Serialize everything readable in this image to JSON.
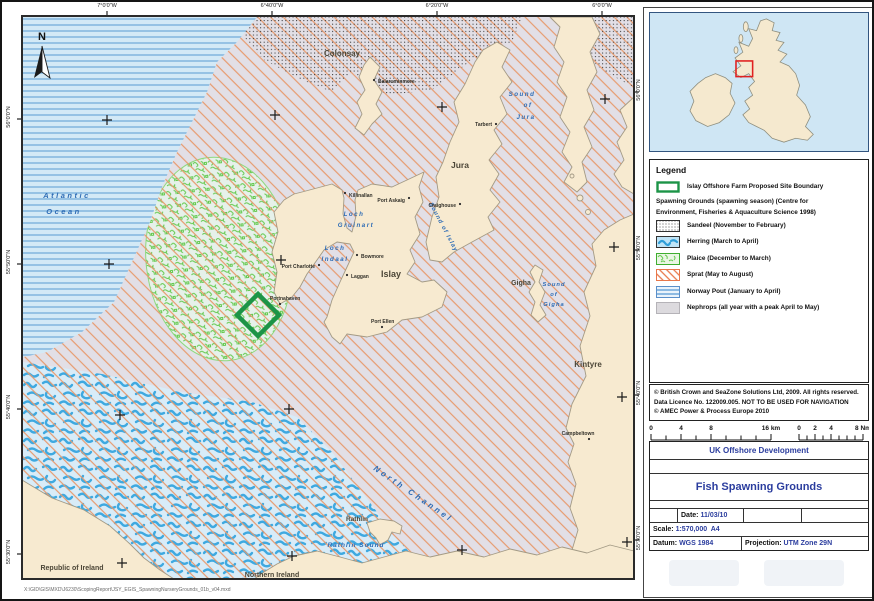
{
  "map": {
    "north_label": "N",
    "axis": {
      "top": [
        "7°0'0\"W",
        "6°40'0\"W",
        "6°20'0\"W",
        "6°0'0\"W"
      ],
      "left": [
        "56°0'0\"N",
        "55°50'0\"N",
        "55°40'0\"N",
        "55°30'0\"N"
      ],
      "right": [
        "56°0'0\"N",
        "55°50'0\"N",
        "55°40'0\"N",
        "55°30'0\"N"
      ]
    },
    "water": {
      "atlantic": [
        "Atlantic",
        "Ocean"
      ],
      "loch_gruinart": [
        "Loch",
        "Gruinart"
      ],
      "loch_indaal": [
        "Loch",
        "Indaal"
      ],
      "sound_of_islay": "Sound of Islay",
      "sound_of_jura": [
        "Sound",
        "of",
        "Jura"
      ],
      "sound_of_gigha": [
        "Sound",
        "of",
        "Gigha"
      ],
      "north_channel": "North Channel",
      "rathlin_sound": "Rathlin Sound"
    },
    "places": {
      "colonsay": "Colonsay",
      "balaruminmore": "Balaruminmore",
      "jura": "Jura",
      "tarbert": "Tarbert",
      "craighouse": "Craighouse",
      "killinallan": "Killinallan",
      "port_askaig": "Port Askaig",
      "islay": "Islay",
      "bowmore": "Bowmore",
      "port_charlotte": "Port Charlotte",
      "laggan": "Laggan",
      "portnahaven": "Portnahaven",
      "port_ellen": "Port Ellen",
      "gigha": "Gigha",
      "kintyre": "Kintyre",
      "campbeltown": "Campbeltown",
      "rathlin": "Rathlin",
      "republic_of_ireland": "Republic of Ireland",
      "northern_ireland": "Northern Ireland"
    },
    "file_path": "X:\\GID\\GIS\\MXD\\J6230\\ScopingReport\\JSY_EGIS_SpawningNurseryGrounds_01b_v04.mxd"
  },
  "legend": {
    "title": "Legend",
    "boundary_label": "Islay Offshore Farm Proposed Site Boundary",
    "subtitle_line1": "Spawning Grounds (spawning season) (Centre for",
    "subtitle_line2": "Environment, Fisheries & Aquaculture Science 1998)",
    "items": [
      {
        "label": "Sandeel (November to February)"
      },
      {
        "label": "Herring (March to April)"
      },
      {
        "label": "Plaice (December to March)"
      },
      {
        "label": "Sprat (May to August)"
      },
      {
        "label": "Norway Pout (January to April)"
      },
      {
        "label": "Nephrops (all year with a peak April to May)"
      }
    ]
  },
  "copyright": {
    "line1": "© British Crown and SeaZone Solutions Ltd, 2009. All rights reserved.",
    "line2": "Data Licence No. 122009.005. NOT TO BE USED FOR NAVIGATION",
    "line3": "© AMEC Power & Process Europe 2010"
  },
  "scalebar": {
    "km_labels": [
      "0",
      "4",
      "8",
      "16 km"
    ],
    "nm_labels": [
      "0",
      "2",
      "4",
      "8 Nm"
    ]
  },
  "titleblock": {
    "project": "UK Offshore Development",
    "title": "Fish Spawning Grounds",
    "date_label": "Date:",
    "date_value": "11/03/10",
    "scale_label": "Scale:",
    "scale_value": "1:570,000  A4",
    "datum_label": "Datum:",
    "datum_value": "WGS 1984",
    "projection_label": "Projection:",
    "projection_value": "UTM Zone 29N"
  },
  "colors": {
    "sea": "#d8ecf8",
    "land": "#f7ead0",
    "sprat_hatch": "#e79a6e",
    "herring_blue": "#3fa9e0",
    "plaice_green": "#63c94d",
    "norway_pout_blue": "#7cb1dc",
    "nephrops_gray": "#e2dfe6",
    "site_boundary_green": "#1c9447",
    "title_blue": "#2b3d9e",
    "inset_highlight_red": "#e02020"
  }
}
